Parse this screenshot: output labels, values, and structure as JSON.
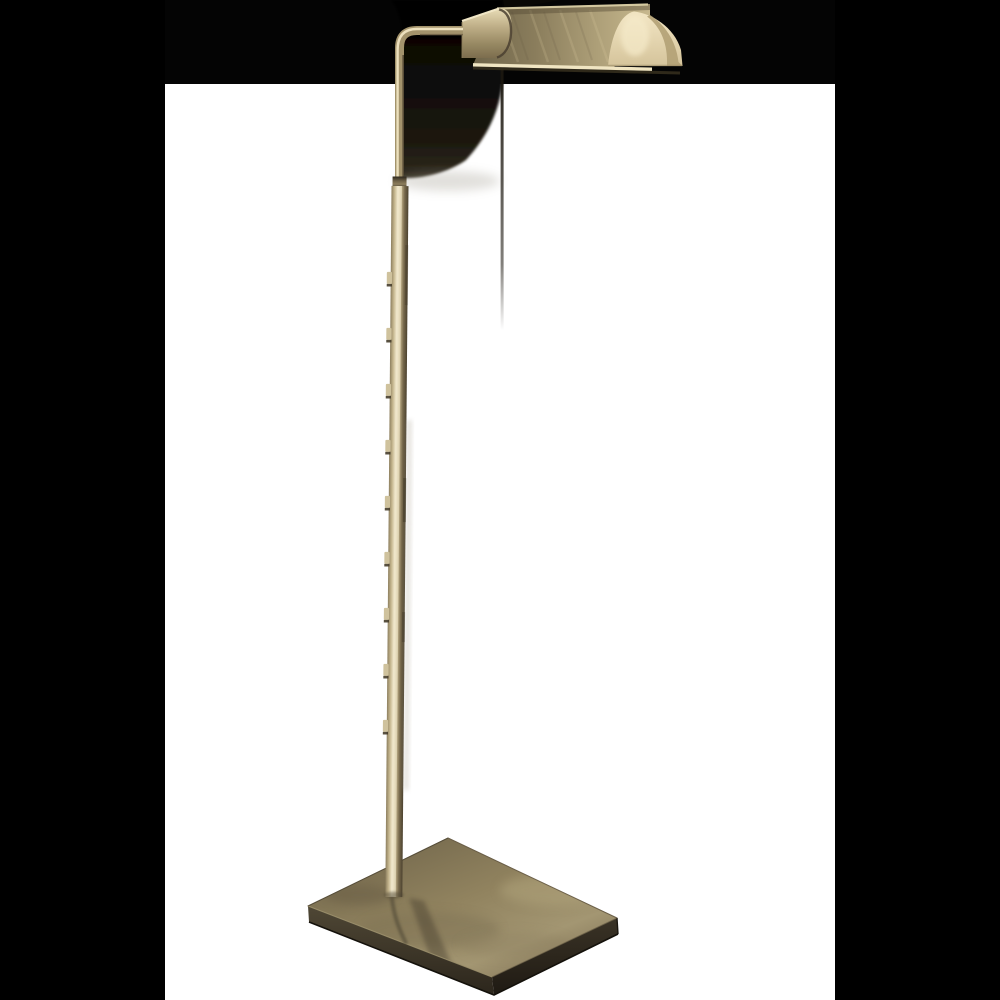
{
  "image": {
    "kind": "product-photo",
    "subject": "brass adjustable pharmacy floor lamp",
    "aria_label": "Cut-out product photograph of a brass adjustable pharmacy floor lamp with a tent-shaped shade, thin notched pole and rectangular bronze base, shown on a white background between black letterbox bars"
  },
  "palette": {
    "letterbox": "#000000",
    "photo-bg": "#ffffff",
    "matte": "#040404",
    "shadow-dark": "#0e0c08",
    "brass-highlight": "#f2e9ce",
    "brass-light": "#d6c8a0",
    "brass-mid": "#b2a27a",
    "brass-deep": "#8a7b5a",
    "brass-dark": "#574c38",
    "shade-cream": "#eadcb8",
    "base-top": "#91835f",
    "base-front": "#352f24"
  }
}
